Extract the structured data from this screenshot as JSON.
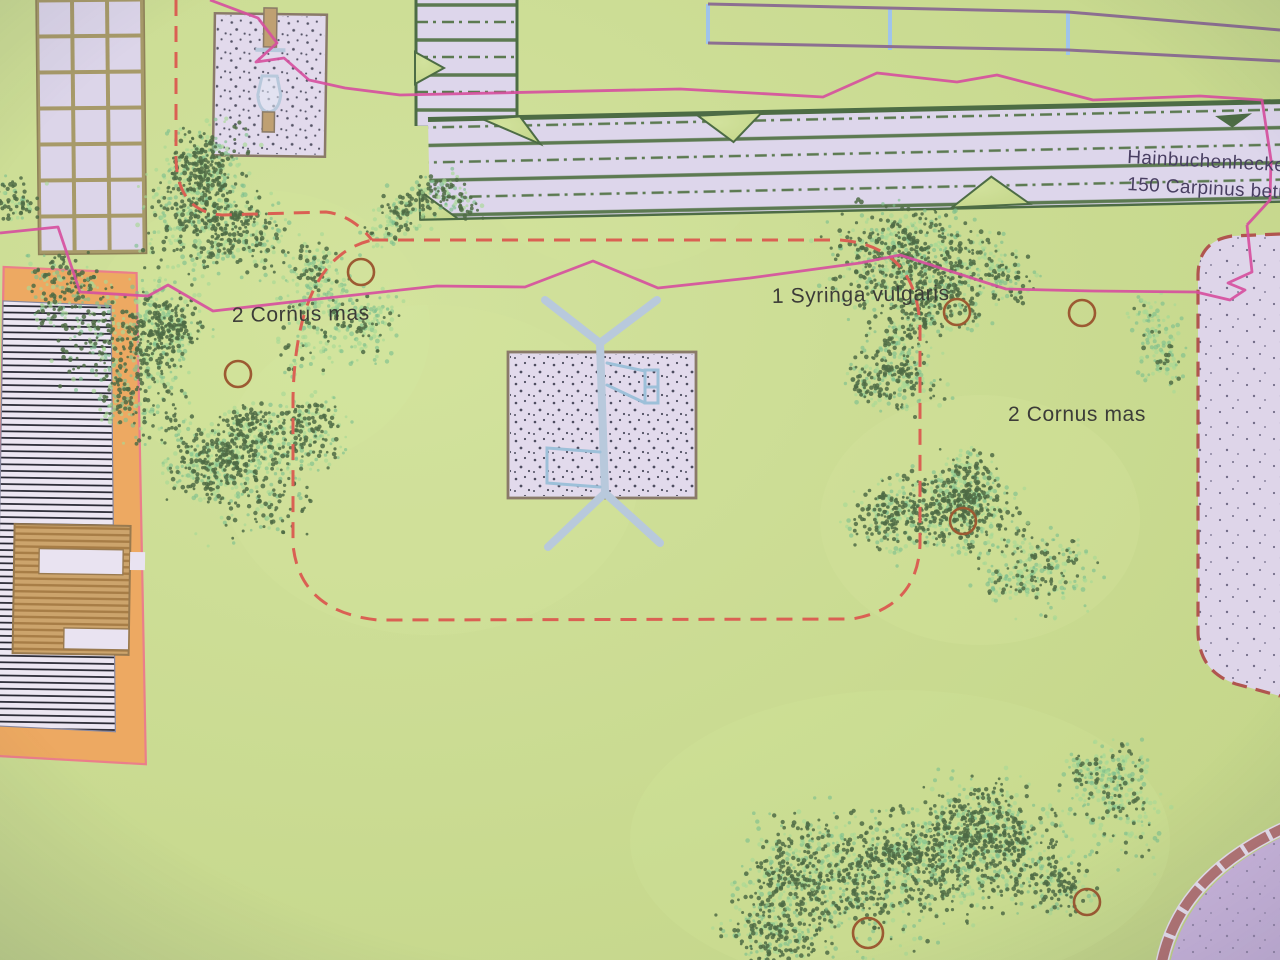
{
  "labels": {
    "cornus_left": "2 Cornus mas",
    "syringa": "1 Syringa vulgaris",
    "cornus_right": "2 Cornus mas",
    "hedge_name": "Hainbuchenhecke",
    "hedge_spec": "150 Carpinus betu"
  },
  "colors": {
    "bgA": "#d2e29b",
    "bgB": "#c3d586",
    "sand": "#e2daec",
    "sandR": "#ded5ea",
    "hedgeFill": "#ddd6ec",
    "hedgeLine": "#5b7a50",
    "hedgeEdge": "#4c6c44",
    "magenta": "#d94f9f",
    "dashedRed": "#dd5f52",
    "dashedBrown": "#b2544e",
    "orange": "#efa95f",
    "pinkOutline": "#ee7d8a",
    "deckTan": "#cda46a",
    "deckStripe": "#a87d44",
    "hatchLine": "#23232e",
    "hatchFill": "#ece6f2",
    "fencePurple": "#8d6f92",
    "fenceBlue": "#9ec4ec",
    "structureBlue": "#b8c9dd",
    "structureDetail": "#9cc0da",
    "shrubDark": "#4d6b44",
    "shrubLight": "#7cc08e",
    "shrubLight2": "#a6d893",
    "plantCircle": "#9e5a30",
    "gridGrout": "#a79a68",
    "tile": "#dcd5ea",
    "curb": "#b57575",
    "pavingPurple": "#cbb6de",
    "labelColor": "#3c3c38",
    "hedgeLabelColor": "#493f63",
    "sandDot": "#3c3c50",
    "borderBrown": "#8a7a68"
  },
  "map": {
    "plant_markers": [
      {
        "x": 361,
        "y": 272,
        "r": 13
      },
      {
        "x": 238,
        "y": 374,
        "r": 13
      },
      {
        "x": 957,
        "y": 312,
        "r": 13
      },
      {
        "x": 1082,
        "y": 313,
        "r": 13
      },
      {
        "x": 963,
        "y": 521,
        "r": 13
      },
      {
        "x": 868,
        "y": 933,
        "r": 15
      },
      {
        "x": 1087,
        "y": 902,
        "r": 13
      }
    ],
    "shrub_clusters": [
      {
        "cx": 195,
        "cy": 205,
        "rx": 100,
        "ry": 82,
        "dark": 1,
        "light": 1,
        "seed": 1
      },
      {
        "cx": 140,
        "cy": 360,
        "rx": 88,
        "ry": 82,
        "dark": 1,
        "light": 1,
        "seed": 2
      },
      {
        "cx": 255,
        "cy": 455,
        "rx": 105,
        "ry": 80,
        "dark": 1,
        "light": 1,
        "seed": 3
      },
      {
        "cx": 330,
        "cy": 310,
        "rx": 75,
        "ry": 70,
        "dark": 0.35,
        "light": 1.1,
        "seed": 4
      },
      {
        "cx": 445,
        "cy": 195,
        "rx": 52,
        "ry": 32,
        "dark": 0.9,
        "light": 0.8,
        "seed": 5
      },
      {
        "cx": 945,
        "cy": 255,
        "rx": 115,
        "ry": 82,
        "dark": 1,
        "light": 1,
        "seed": 6
      },
      {
        "cx": 895,
        "cy": 365,
        "rx": 62,
        "ry": 58,
        "dark": 0.9,
        "light": 0.9,
        "seed": 7
      },
      {
        "cx": 930,
        "cy": 505,
        "rx": 100,
        "ry": 80,
        "dark": 1,
        "light": 1,
        "seed": 8
      },
      {
        "cx": 1035,
        "cy": 565,
        "rx": 72,
        "ry": 48,
        "dark": 0.4,
        "light": 1.1,
        "seed": 9
      },
      {
        "cx": 850,
        "cy": 880,
        "rx": 115,
        "ry": 85,
        "dark": 1,
        "light": 1,
        "seed": 10
      },
      {
        "cx": 1015,
        "cy": 860,
        "rx": 110,
        "ry": 88,
        "dark": 1,
        "light": 1,
        "seed": 11
      },
      {
        "cx": 1120,
        "cy": 800,
        "rx": 78,
        "ry": 58,
        "dark": 0.35,
        "light": 1.1,
        "seed": 12
      },
      {
        "cx": 780,
        "cy": 930,
        "rx": 62,
        "ry": 48,
        "dark": 0.9,
        "light": 0.9,
        "seed": 13
      },
      {
        "cx": 15,
        "cy": 195,
        "rx": 28,
        "ry": 32,
        "dark": 0.9,
        "light": 0.5,
        "seed": 14
      },
      {
        "cx": 395,
        "cy": 225,
        "rx": 42,
        "ry": 30,
        "dark": 0.5,
        "light": 1,
        "seed": 15
      },
      {
        "cx": 1160,
        "cy": 330,
        "rx": 40,
        "ry": 58,
        "dark": 0.15,
        "light": 1,
        "seed": 16
      },
      {
        "cx": 60,
        "cy": 290,
        "rx": 48,
        "ry": 42,
        "dark": 0.8,
        "light": 0.8,
        "seed": 17
      }
    ],
    "paver_grid": {
      "x": 39,
      "y": 2,
      "cols": 3,
      "rows": 7,
      "cellW": 31,
      "cellH": 32,
      "gap": 4
    }
  }
}
